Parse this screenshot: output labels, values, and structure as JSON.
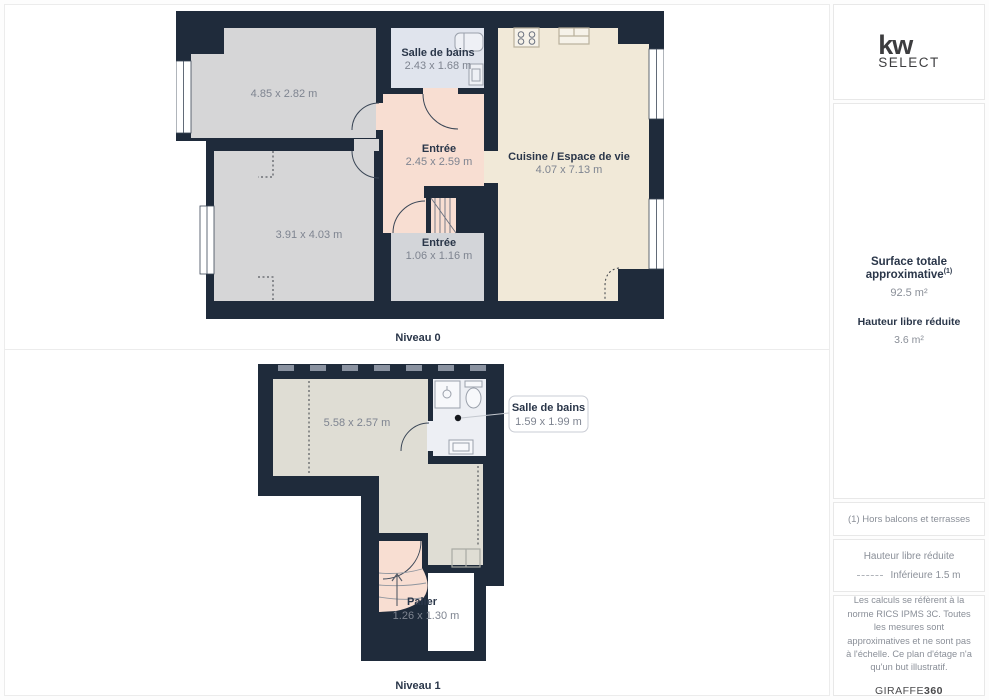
{
  "branding": {
    "logo_top": "kw",
    "logo_bottom": "SELECT"
  },
  "levels": [
    {
      "label": "Niveau 0",
      "rooms": [
        {
          "name": "",
          "dims": "4.85 x 2.82 m"
        },
        {
          "name": "Salle de bains",
          "dims": "2.43 x 1.68 m"
        },
        {
          "name": "Entrée",
          "dims": "2.45 x 2.59 m"
        },
        {
          "name": "Cuisine / Espace de vie",
          "dims": "4.07 x 7.13 m"
        },
        {
          "name": "",
          "dims": "3.91 x 4.03 m"
        },
        {
          "name": "Entrée",
          "dims": "1.06 x 1.16 m"
        }
      ]
    },
    {
      "label": "Niveau 1",
      "rooms": [
        {
          "name": "",
          "dims": "5.58 x 2.57 m"
        },
        {
          "name": "Salle de bains",
          "dims": "1.59 x 1.99 m"
        },
        {
          "name": "Palier",
          "dims": "1.26 x 1.30 m"
        }
      ]
    }
  ],
  "sidebar": {
    "surface_label": "Surface totale approximative",
    "surface_sup": "(1)",
    "surface_value": "92.5 m²",
    "hauteur_label": "Hauteur libre réduite",
    "hauteur_value": "3.6 m²",
    "footnote": "(1) Hors balcons et terrasses",
    "legend_title": "Hauteur libre réduite",
    "legend_value": "Inférieure 1.5 m",
    "disclaimer": "Les calculs se réfèrent à la norme RICS IPMS 3C. Toutes les mesures sont approximatives et ne sont pas à l'échelle. Ce plan d'étage n'a qu'un but illustratif.",
    "brand": "GIRAFFE",
    "brand_bold": "360"
  },
  "colors": {
    "wall": "#1f2b3b",
    "room_gray": "#d6d6d7",
    "room_gray_cool": "#d3d5d9",
    "kitchen_cream": "#f1e9d8",
    "entree_peach": "#f8ded2",
    "bath_blue": "#e0e4ed",
    "bath_white": "#edeff4",
    "n1_gray": "#dfddd4",
    "label_navy": "#2a3649",
    "dims_gray": "#7e8490"
  }
}
